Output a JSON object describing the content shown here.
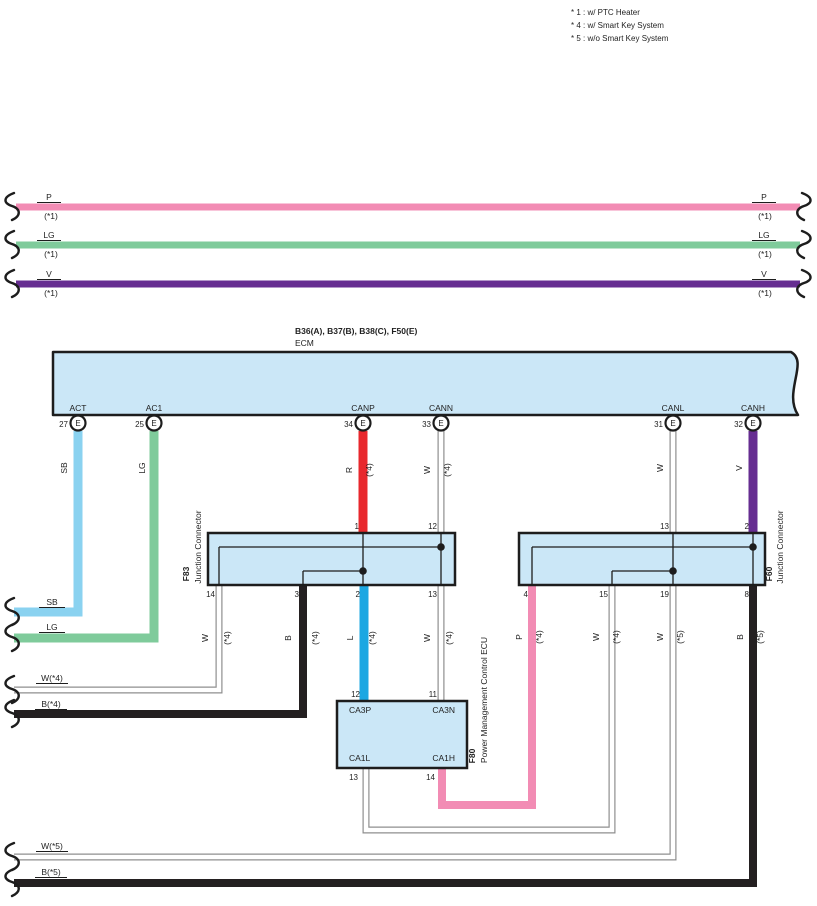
{
  "legend": {
    "lines": [
      "* 1 : w/ PTC Heater",
      "* 4 : w/ Smart Key System",
      "* 5 : w/o Smart Key System"
    ]
  },
  "colors": {
    "pink": "#F28CB4",
    "green": "#7FCB9B",
    "purple": "#662D91",
    "skyblue": "#8AD2F0",
    "red": "#E8282D",
    "blue": "#1BA7E2",
    "black": "#242021",
    "wire_outline": "#8F8F8F",
    "box_fill": "#CBE7F7",
    "box_stroke": "#1D1D1D",
    "line": "#1D1D1D"
  },
  "ecm": {
    "title": "B36(A), B37(B), B38(C), F50(E)",
    "subtitle": "ECM",
    "path": "M53,352 L791,352 C809,362 783,392 798,415 L53,415 Z",
    "pin_letter": "E",
    "pins": [
      {
        "num": "27",
        "label": "ACT",
        "x": 78
      },
      {
        "num": "25",
        "label": "AC1",
        "x": 154
      },
      {
        "num": "34",
        "label": "CANP",
        "x": 363
      },
      {
        "num": "33",
        "label": "CANN",
        "x": 441
      },
      {
        "num": "31",
        "label": "CANL",
        "x": 673
      },
      {
        "num": "32",
        "label": "CANH",
        "x": 753
      }
    ]
  },
  "boxes": [
    {
      "name": "f83-junction-connector-box",
      "x": 208,
      "y": 533,
      "w": 247,
      "h": 52
    },
    {
      "name": "f60-junction-connector-box",
      "x": 519,
      "y": 533,
      "w": 246,
      "h": 52
    },
    {
      "name": "f80-power-management-ecu-box",
      "x": 337,
      "y": 701,
      "w": 130,
      "h": 67
    }
  ],
  "wires": [
    {
      "name": "wire-p-top",
      "color": "pink",
      "width": 7,
      "points": [
        [
          16,
          207
        ],
        [
          800,
          207
        ]
      ]
    },
    {
      "name": "wire-lg-top",
      "color": "green",
      "width": 7,
      "points": [
        [
          16,
          245
        ],
        [
          800,
          245
        ]
      ]
    },
    {
      "name": "wire-v-top",
      "color": "purple",
      "width": 7,
      "points": [
        [
          16,
          284
        ],
        [
          800,
          284
        ]
      ]
    },
    {
      "name": "wire-sb-act",
      "color": "skyblue",
      "width": 9,
      "points": [
        [
          78,
          431
        ],
        [
          78,
          612
        ],
        [
          14,
          612
        ]
      ]
    },
    {
      "name": "wire-lg-ac1",
      "color": "green",
      "width": 9,
      "points": [
        [
          154,
          431
        ],
        [
          154,
          638
        ],
        [
          14,
          638
        ]
      ]
    },
    {
      "name": "wire-r-canp",
      "color": "red",
      "width": 9,
      "points": [
        [
          363,
          431
        ],
        [
          363,
          533
        ]
      ]
    },
    {
      "name": "wire-w-cann",
      "color": "white",
      "width": 7,
      "points": [
        [
          441,
          431
        ],
        [
          441,
          533
        ]
      ]
    },
    {
      "name": "wire-w-canl",
      "color": "white",
      "width": 7,
      "points": [
        [
          673,
          431
        ],
        [
          673,
          533
        ]
      ]
    },
    {
      "name": "wire-v-canh",
      "color": "purple",
      "width": 9,
      "points": [
        [
          753,
          431
        ],
        [
          753,
          533
        ]
      ]
    },
    {
      "name": "wire-w-f83-14",
      "color": "white",
      "width": 7,
      "points": [
        [
          219,
          585
        ],
        [
          219,
          690
        ],
        [
          14,
          690
        ]
      ]
    },
    {
      "name": "wire-b-f83-3",
      "color": "black",
      "width": 8,
      "points": [
        [
          303,
          585
        ],
        [
          303,
          714
        ],
        [
          14,
          714
        ]
      ]
    },
    {
      "name": "wire-l-f83-2",
      "color": "blue",
      "width": 9,
      "points": [
        [
          364,
          585
        ],
        [
          364,
          701
        ]
      ]
    },
    {
      "name": "wire-w-f83-13",
      "color": "white",
      "width": 7,
      "points": [
        [
          441,
          585
        ],
        [
          441,
          701
        ]
      ]
    },
    {
      "name": "wire-p-f60-4",
      "color": "pink",
      "width": 8,
      "points": [
        [
          532,
          585
        ],
        [
          532,
          805
        ],
        [
          442,
          805
        ],
        [
          442,
          768
        ]
      ]
    },
    {
      "name": "wire-w-f60-15",
      "color": "white",
      "width": 7,
      "points": [
        [
          612,
          585
        ],
        [
          612,
          830
        ],
        [
          366,
          830
        ],
        [
          366,
          768
        ]
      ]
    },
    {
      "name": "wire-w-f60-19",
      "color": "white",
      "width": 7,
      "points": [
        [
          673,
          585
        ],
        [
          673,
          857
        ],
        [
          14,
          857
        ]
      ]
    },
    {
      "name": "wire-b-f60-8",
      "color": "black",
      "width": 8,
      "points": [
        [
          753,
          585
        ],
        [
          753,
          883
        ],
        [
          14,
          883
        ]
      ]
    }
  ],
  "inner_lines": [
    [
      [
        363,
        533
      ],
      [
        363,
        585
      ]
    ],
    [
      [
        441,
        533
      ],
      [
        441,
        585
      ]
    ],
    [
      [
        219,
        547
      ],
      [
        441,
        547
      ]
    ],
    [
      [
        219,
        547
      ],
      [
        219,
        585
      ]
    ],
    [
      [
        303,
        571
      ],
      [
        363,
        571
      ]
    ],
    [
      [
        303,
        571
      ],
      [
        303,
        585
      ]
    ],
    [
      [
        753,
        533
      ],
      [
        753,
        585
      ]
    ],
    [
      [
        532,
        547
      ],
      [
        753,
        547
      ]
    ],
    [
      [
        532,
        547
      ],
      [
        532,
        585
      ]
    ],
    [
      [
        673,
        533
      ],
      [
        673,
        585
      ]
    ],
    [
      [
        612,
        571
      ],
      [
        673,
        571
      ]
    ],
    [
      [
        612,
        571
      ],
      [
        612,
        585
      ]
    ]
  ],
  "dots": [
    [
      441,
      547
    ],
    [
      363,
      571
    ],
    [
      753,
      547
    ],
    [
      673,
      571
    ]
  ],
  "pin_numbers": [
    {
      "t": "1",
      "x": 359,
      "y": 529
    },
    {
      "t": "12",
      "x": 437,
      "y": 529
    },
    {
      "t": "14",
      "x": 215,
      "y": 597
    },
    {
      "t": "3",
      "x": 299,
      "y": 597
    },
    {
      "t": "2",
      "x": 360,
      "y": 597
    },
    {
      "t": "13",
      "x": 437,
      "y": 597
    },
    {
      "t": "13",
      "x": 669,
      "y": 529
    },
    {
      "t": "2",
      "x": 749,
      "y": 529
    },
    {
      "t": "4",
      "x": 528,
      "y": 597
    },
    {
      "t": "15",
      "x": 608,
      "y": 597
    },
    {
      "t": "19",
      "x": 669,
      "y": 597
    },
    {
      "t": "8",
      "x": 749,
      "y": 597
    },
    {
      "t": "12",
      "x": 360,
      "y": 697
    },
    {
      "t": "11",
      "x": 437,
      "y": 697
    },
    {
      "t": "13",
      "x": 358,
      "y": 780
    },
    {
      "t": "14",
      "x": 435,
      "y": 780
    }
  ],
  "texts": [
    {
      "t": "B36(A), B37(B), B38(C), F50(E)",
      "x": 295,
      "y": 334,
      "a": "start",
      "b": 1
    },
    {
      "t": "ECM",
      "x": 295,
      "y": 346,
      "a": "start"
    },
    {
      "t": "P",
      "x": 49,
      "y": 200,
      "u": 24
    },
    {
      "t": "(*1)",
      "x": 51,
      "y": 219
    },
    {
      "t": "LG",
      "x": 49,
      "y": 238,
      "u": 24
    },
    {
      "t": "(*1)",
      "x": 51,
      "y": 257
    },
    {
      "t": "V",
      "x": 49,
      "y": 277,
      "u": 24
    },
    {
      "t": "(*1)",
      "x": 51,
      "y": 296
    },
    {
      "t": "P",
      "x": 764,
      "y": 200,
      "u": 24
    },
    {
      "t": "(*1)",
      "x": 765,
      "y": 219
    },
    {
      "t": "LG",
      "x": 764,
      "y": 238,
      "u": 24
    },
    {
      "t": "(*1)",
      "x": 765,
      "y": 257
    },
    {
      "t": "V",
      "x": 764,
      "y": 277,
      "u": 24
    },
    {
      "t": "(*1)",
      "x": 765,
      "y": 296
    },
    {
      "t": "SB",
      "x": 52,
      "y": 605,
      "u": 26
    },
    {
      "t": "LG",
      "x": 52,
      "y": 630,
      "u": 26
    },
    {
      "t": "W(*4)",
      "x": 52,
      "y": 681,
      "u": 32
    },
    {
      "t": "B(*4)",
      "x": 51,
      "y": 707,
      "u": 32
    },
    {
      "t": "W(*5)",
      "x": 52,
      "y": 849,
      "u": 32
    },
    {
      "t": "B(*5)",
      "x": 51,
      "y": 875,
      "u": 32
    },
    {
      "t": "CA3P",
      "x": 349,
      "y": 713,
      "a": "start"
    },
    {
      "t": "CA3N",
      "x": 455,
      "y": 713,
      "a": "end"
    },
    {
      "t": "CA1L",
      "x": 349,
      "y": 761,
      "a": "start"
    },
    {
      "t": "CA1H",
      "x": 455,
      "y": 761,
      "a": "end"
    }
  ],
  "vtexts": [
    {
      "t": "SB",
      "x": 67,
      "y": 468
    },
    {
      "t": "LG",
      "x": 145,
      "y": 468
    },
    {
      "t": "R",
      "x": 352,
      "y": 470
    },
    {
      "t": "(*4)",
      "x": 372,
      "y": 470
    },
    {
      "t": "W",
      "x": 430,
      "y": 470
    },
    {
      "t": "(*4)",
      "x": 450,
      "y": 470
    },
    {
      "t": "W",
      "x": 663,
      "y": 468
    },
    {
      "t": "V",
      "x": 742,
      "y": 468
    },
    {
      "t": "W",
      "x": 208,
      "y": 638
    },
    {
      "t": "(*4)",
      "x": 230,
      "y": 638
    },
    {
      "t": "B",
      "x": 291,
      "y": 638
    },
    {
      "t": "(*4)",
      "x": 318,
      "y": 638
    },
    {
      "t": "L",
      "x": 353,
      "y": 638
    },
    {
      "t": "(*4)",
      "x": 375,
      "y": 638
    },
    {
      "t": "W",
      "x": 430,
      "y": 638
    },
    {
      "t": "(*4)",
      "x": 452,
      "y": 638
    },
    {
      "t": "P",
      "x": 522,
      "y": 637
    },
    {
      "t": "(*4)",
      "x": 542,
      "y": 637
    },
    {
      "t": "W",
      "x": 599,
      "y": 637
    },
    {
      "t": "(*4)",
      "x": 619,
      "y": 637
    },
    {
      "t": "W",
      "x": 663,
      "y": 637
    },
    {
      "t": "(*5)",
      "x": 683,
      "y": 637
    },
    {
      "t": "B",
      "x": 743,
      "y": 637
    },
    {
      "t": "(*5)",
      "x": 763,
      "y": 637
    },
    {
      "t": "F83",
      "x": 189,
      "y": 574,
      "b": 1
    },
    {
      "t": "Junction Connector",
      "x": 201,
      "y": 547
    },
    {
      "t": "F60",
      "x": 772,
      "y": 574,
      "b": 1
    },
    {
      "t": "Junction Connector",
      "x": 783,
      "y": 547
    },
    {
      "t": "F80",
      "x": 475,
      "y": 756,
      "b": 1
    },
    {
      "t": "Power Management Control ECU",
      "x": 487,
      "y": 700
    }
  ],
  "squiggles": [
    {
      "x": 10,
      "y": 207
    },
    {
      "x": 806,
      "y": 207,
      "flip": 1
    },
    {
      "x": 10,
      "y": 245
    },
    {
      "x": 806,
      "y": 245,
      "flip": 1
    },
    {
      "x": 10,
      "y": 284
    },
    {
      "x": 806,
      "y": 284,
      "flip": 1
    },
    {
      "x": 10,
      "y": 612
    },
    {
      "x": 10,
      "y": 638
    },
    {
      "x": 10,
      "y": 690
    },
    {
      "x": 10,
      "y": 714
    },
    {
      "x": 10,
      "y": 857
    },
    {
      "x": 10,
      "y": 883
    }
  ]
}
